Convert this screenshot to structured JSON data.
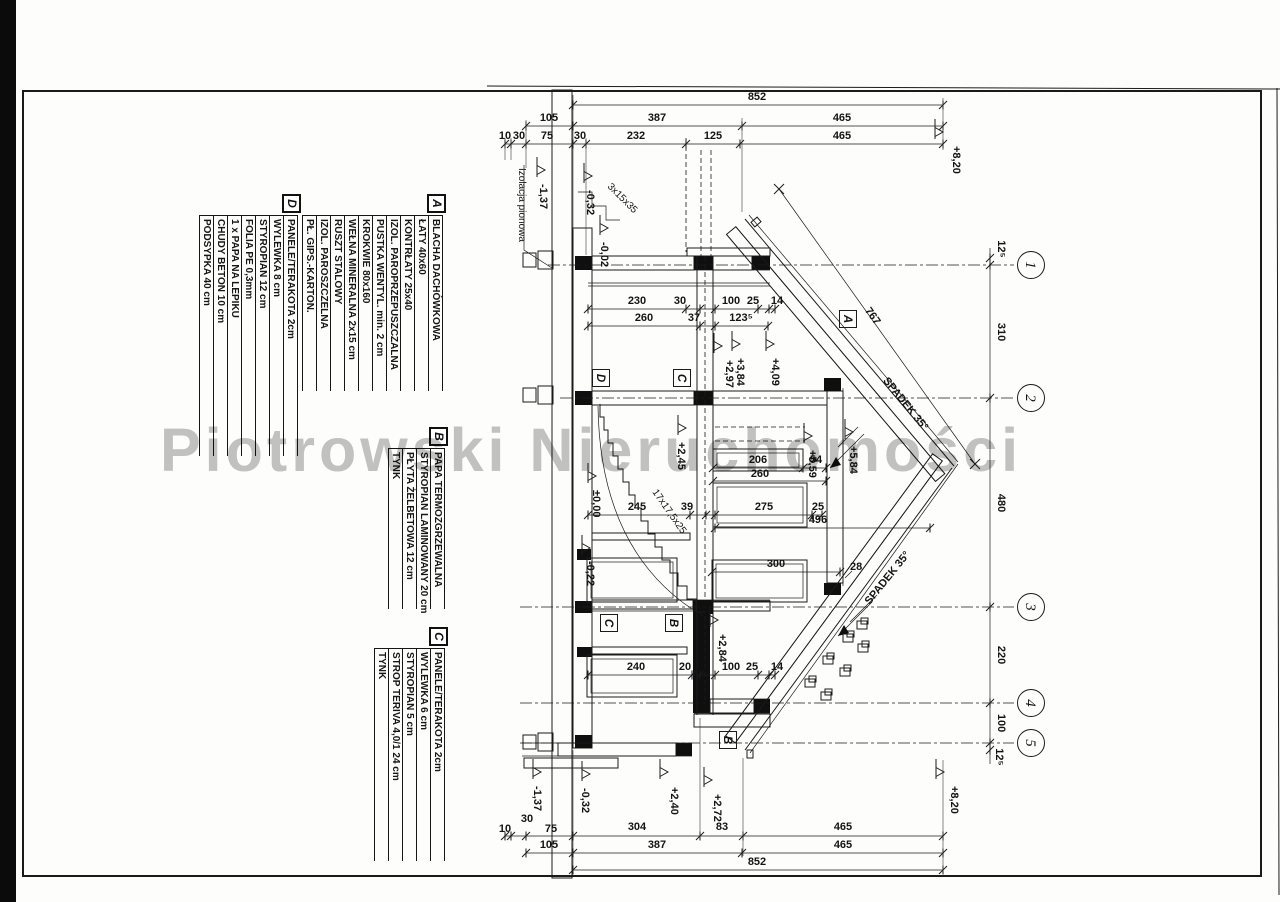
{
  "watermark": {
    "text": "Piotrowski Nieruchomości"
  },
  "legends": {
    "a": {
      "label": "A",
      "items": [
        "BLACHA DACHÓWKOWA",
        "ŁATY 40x60",
        "KONTRŁATY 25x40",
        "IZOL. PAROPRZEPUSZCZALNA",
        "PUSTKA WENTYL. min. 2 cm",
        "KROKWIE 80x160",
        "WEŁNA MINERALNA 2x15 cm",
        "RUSZT STALOWY",
        "IZOL. PAROSZCZELNA",
        "PŁ. GIPS.-KARTON."
      ]
    },
    "b": {
      "label": "B",
      "items": [
        "PAPA TERMOZGRZEWALNA",
        "STYROPIAN LAMINOWANY 20 cm",
        "PŁYTA ŻELBETOWA 12 cm",
        "TYNK"
      ]
    },
    "c": {
      "label": "C",
      "items": [
        "PANELE/TERAKOTA 2cm",
        "WYLEWKA 6 cm",
        "STYROPIAN 5 cm",
        "STROP TERIVA 4,0/1 24 cm",
        "TYNK"
      ]
    },
    "d": {
      "label": "D",
      "items": [
        "PANELE/TERAKOTA 2cm",
        "WYLEWKA 8 cm",
        "STYROPIAN 12 cm",
        "FOLIA PE 0,3mm",
        "1 x PAPA NA LEPIKU",
        "CHUDY BETON 10 cm",
        "PODSYPKA 40 cm"
      ]
    }
  },
  "marks": {
    "a": "A",
    "b": "B",
    "c": "C",
    "d": "D"
  },
  "dims": {
    "top": {
      "total": "852",
      "row2": [
        "105",
        "387",
        "465"
      ],
      "row3": [
        "10",
        "30",
        "75",
        "30",
        "232",
        "125",
        "465"
      ]
    },
    "bottom": {
      "total": "852",
      "row2": [
        "105",
        "387",
        "465"
      ],
      "row3": [
        "10",
        "30",
        "75",
        "304",
        "83",
        "465"
      ]
    },
    "upper": {
      "row1": [
        "230",
        "30",
        "100",
        "25",
        "14"
      ],
      "row2": [
        "260",
        "37",
        "123⁵"
      ]
    },
    "mid": {
      "d206": "206",
      "d54": "54",
      "d260": "260",
      "d245": "245",
      "d39": "39",
      "d275": "275",
      "d25": "25",
      "d496": "496",
      "d300": "300",
      "d28": "28"
    },
    "lower": [
      "240",
      "20",
      "100",
      "25",
      "14"
    ],
    "axis": [
      "12⁵",
      "310",
      "480",
      "220",
      "100",
      "12⁵"
    ]
  },
  "levels": {
    "m137": "-1,37",
    "m032": "-0,32",
    "m002": "-0,02",
    "m022": "-0,22",
    "zero": "±0,00",
    "p240": "+2,40",
    "p245": "+2,45",
    "p272": "+2,72",
    "p284": "+2,84",
    "p297": "+2,97",
    "p384": "+3,84",
    "p409": "+4,09",
    "p559": "+5,59",
    "p584": "+5,84",
    "p820": "+8,20"
  },
  "axes": [
    "1",
    "2",
    "3",
    "4",
    "5"
  ],
  "notes": {
    "izolacja": "Izolacja pionowa",
    "steps": "3x15x35",
    "stairs": "17x17,5x25",
    "roof767": "767",
    "spadek": "SPADEK 35°"
  }
}
